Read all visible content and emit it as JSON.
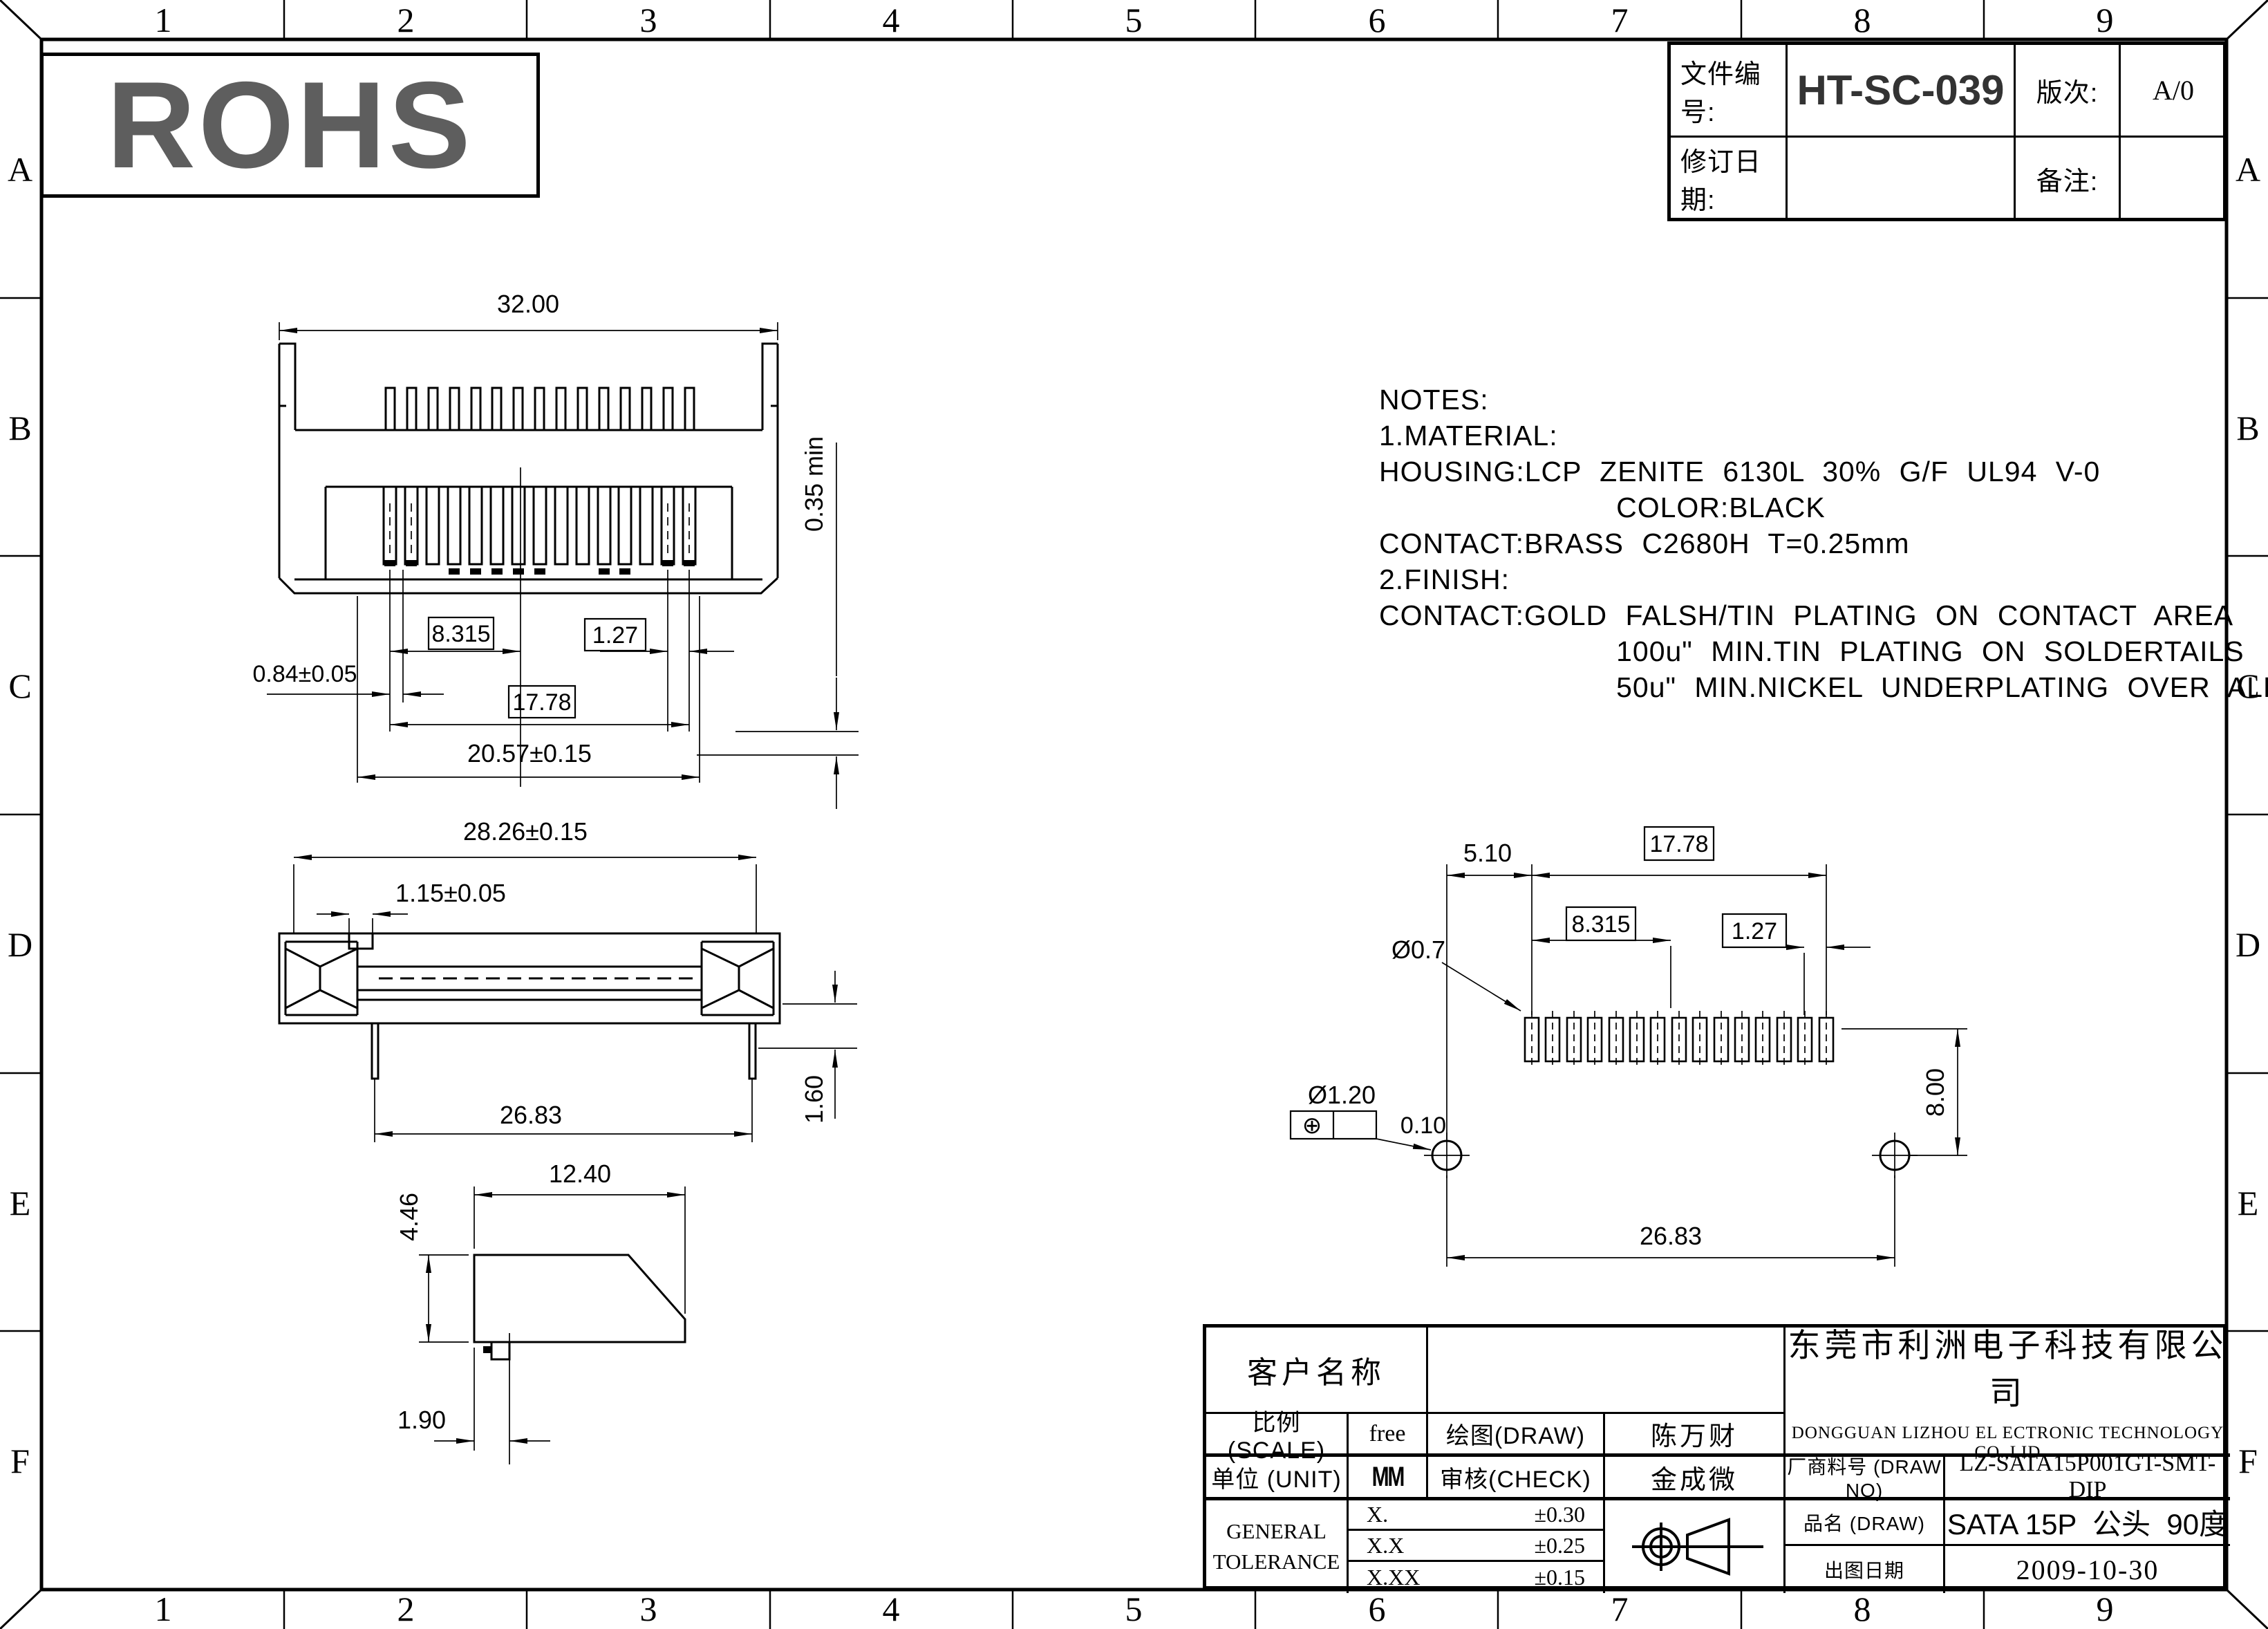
{
  "frame": {
    "cols": [
      "1",
      "2",
      "3",
      "4",
      "5",
      "6",
      "7",
      "8",
      "9"
    ],
    "rows": [
      "A",
      "B",
      "C",
      "D",
      "E",
      "F"
    ]
  },
  "rohs": {
    "text": "ROHS",
    "color": "#5e5e5e"
  },
  "doc_header": {
    "file_no_label": "文件编号:",
    "file_no": "HT-SC-039",
    "rev_label": "版次:",
    "rev": "A/0",
    "rev_date_label": "修订日期:",
    "rev_date": "",
    "remark_label": "备注:",
    "remark": ""
  },
  "notes": {
    "lines": [
      "NOTES:",
      "1.MATERIAL:",
      "HOUSING:LCP ZENITE 6130L 30% G/F UL94 V-0",
      "             COLOR:BLACK",
      "CONTACT:BRASS C2680H T=0.25mm",
      "2.FINISH:",
      "CONTACT:GOLD FALSH/TIN PLATING ON CONTACT AREA",
      "             100u\" MIN.TIN PLATING ON SOLDERTAILS",
      "             50u\" MIN.NICKEL UNDERPLATING OVER ALL"
    ]
  },
  "dims": {
    "front": {
      "overall_width": "32.00",
      "contact_min": "0.35 min",
      "pitch_center": "8.315",
      "pitch": "1.27",
      "tab_offset": "0.84±0.05",
      "contact_span": "17.78",
      "slot_span": "20.57±0.15"
    },
    "bottom": {
      "overall": "28.26±0.15",
      "latch": "1.15±0.05",
      "pin_span": "26.83",
      "pin_height": "1.60"
    },
    "side": {
      "depth": "12.40",
      "height": "4.46",
      "foot_offset": "1.90"
    },
    "pcb": {
      "edge_offset": "5.10",
      "pad_span": "17.78",
      "center_offset": "8.315",
      "pad_pitch": "1.27",
      "pad_dia": "Ø0.7",
      "hole_dia": "Ø1.20",
      "position_symbol": "⊕",
      "position_tol": "0.10",
      "hole_offset": "8.00",
      "hole_span": "26.83"
    }
  },
  "title_block": {
    "customer_label": "客户名称",
    "customer": "",
    "company_cn": "东莞市利洲电子科技有限公司",
    "company_en": "DONGGUAN LIZHOU EL ECTRONIC TECHNOLOGY CO.,LID",
    "scale_label": "比例 (SCALE)",
    "scale": "free",
    "draw_label": "绘图(DRAW)",
    "draw": "陈万财",
    "unit_label": "单位 (UNIT)",
    "unit": "MM",
    "check_label": "审核(CHECK)",
    "check": "金成微",
    "part_no_label": "厂商料号 (DRAW NO)",
    "part_no": "LZ-SATA15P001GT-SMT-DIP",
    "tolerance_label_1": "GENERAL",
    "tolerance_label_2": "TOLERANCE",
    "tol_rows": [
      {
        "k": "X.",
        "v": "±0.30"
      },
      {
        "k": "X.X",
        "v": "±0.25"
      },
      {
        "k": "X.XX",
        "v": "±0.15"
      }
    ],
    "name_label": "品名 (DRAW)",
    "name": "SATA 15P  公头  90度",
    "date_label": "出图日期",
    "date": "2009-10-30"
  }
}
